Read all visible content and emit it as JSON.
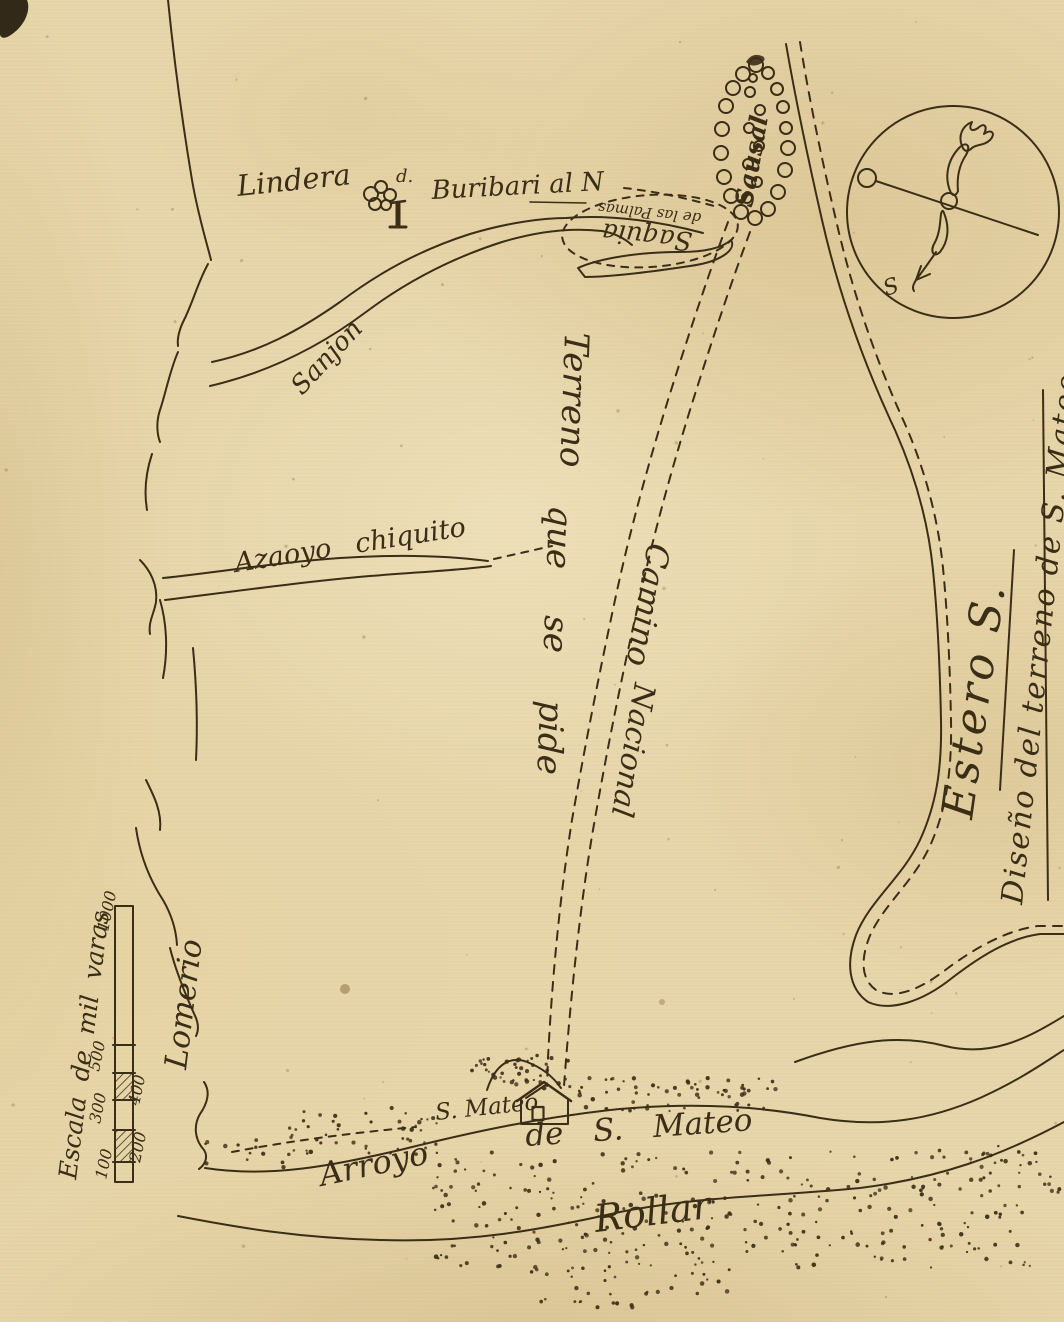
{
  "map": {
    "title": "Diseño del terreno de S. Mateo",
    "labels": {
      "lindero": "Lindera",
      "tree_marker": "d.",
      "buribari": "Buribari al N",
      "saquia_main": "Saquia",
      "saquia_sub": "de las Palmas",
      "sausal": "Sausal",
      "sanjon": "Sanjon",
      "azaoyo_chiquito": "Azaoyo chiquito",
      "terreno_1": "Terreno",
      "terreno_2": "que",
      "terreno_3": "se",
      "terreno_4": "pide",
      "camino_1": "Camino",
      "camino_2": "Nacional",
      "lomerio": "Lomerio",
      "san_mateo": "S. Mateo",
      "arroyo": "Arroyo",
      "arroyo_de": "de S. Mateo",
      "rollar": "Rollar",
      "estero": "Estero S.",
      "diseno_title": "Diseño del terreno de S. Mateo",
      "compass_s": "S"
    },
    "scale_bar": {
      "title": "Escala de mil varas",
      "left_ticks": [
        "100",
        "300",
        "500",
        "1000"
      ],
      "right_ticks": [
        "200",
        "400"
      ]
    },
    "colors": {
      "paper": "#e7d6ab",
      "ink": "#3b2e16"
    }
  }
}
